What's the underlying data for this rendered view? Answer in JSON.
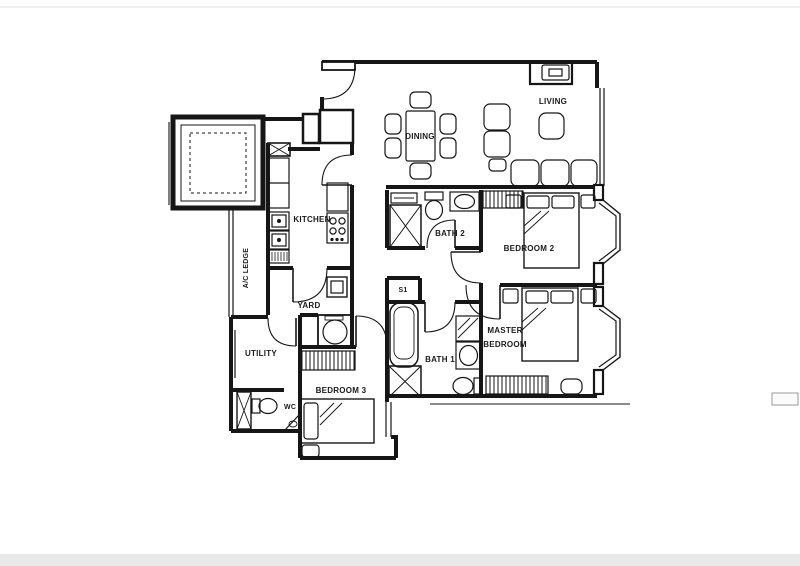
{
  "page": {
    "background": "#ffffff",
    "ink": "#161616",
    "faint": "#bbbbbb"
  },
  "rooms": {
    "living": "LIVING",
    "dining": "DINING",
    "kitchen": "KITCHEN",
    "ac_ledge": "A/C LEDGE",
    "yard": "YARD",
    "utility": "UTILITY",
    "wc": "WC",
    "bedroom3": "BEDROOM 3",
    "bath1": "BATH 1",
    "bath2": "BATH 2",
    "bedroom2": "BEDROOM 2",
    "master_line1": "MASTER",
    "master_line2": "BEDROOM",
    "store": "S1"
  }
}
